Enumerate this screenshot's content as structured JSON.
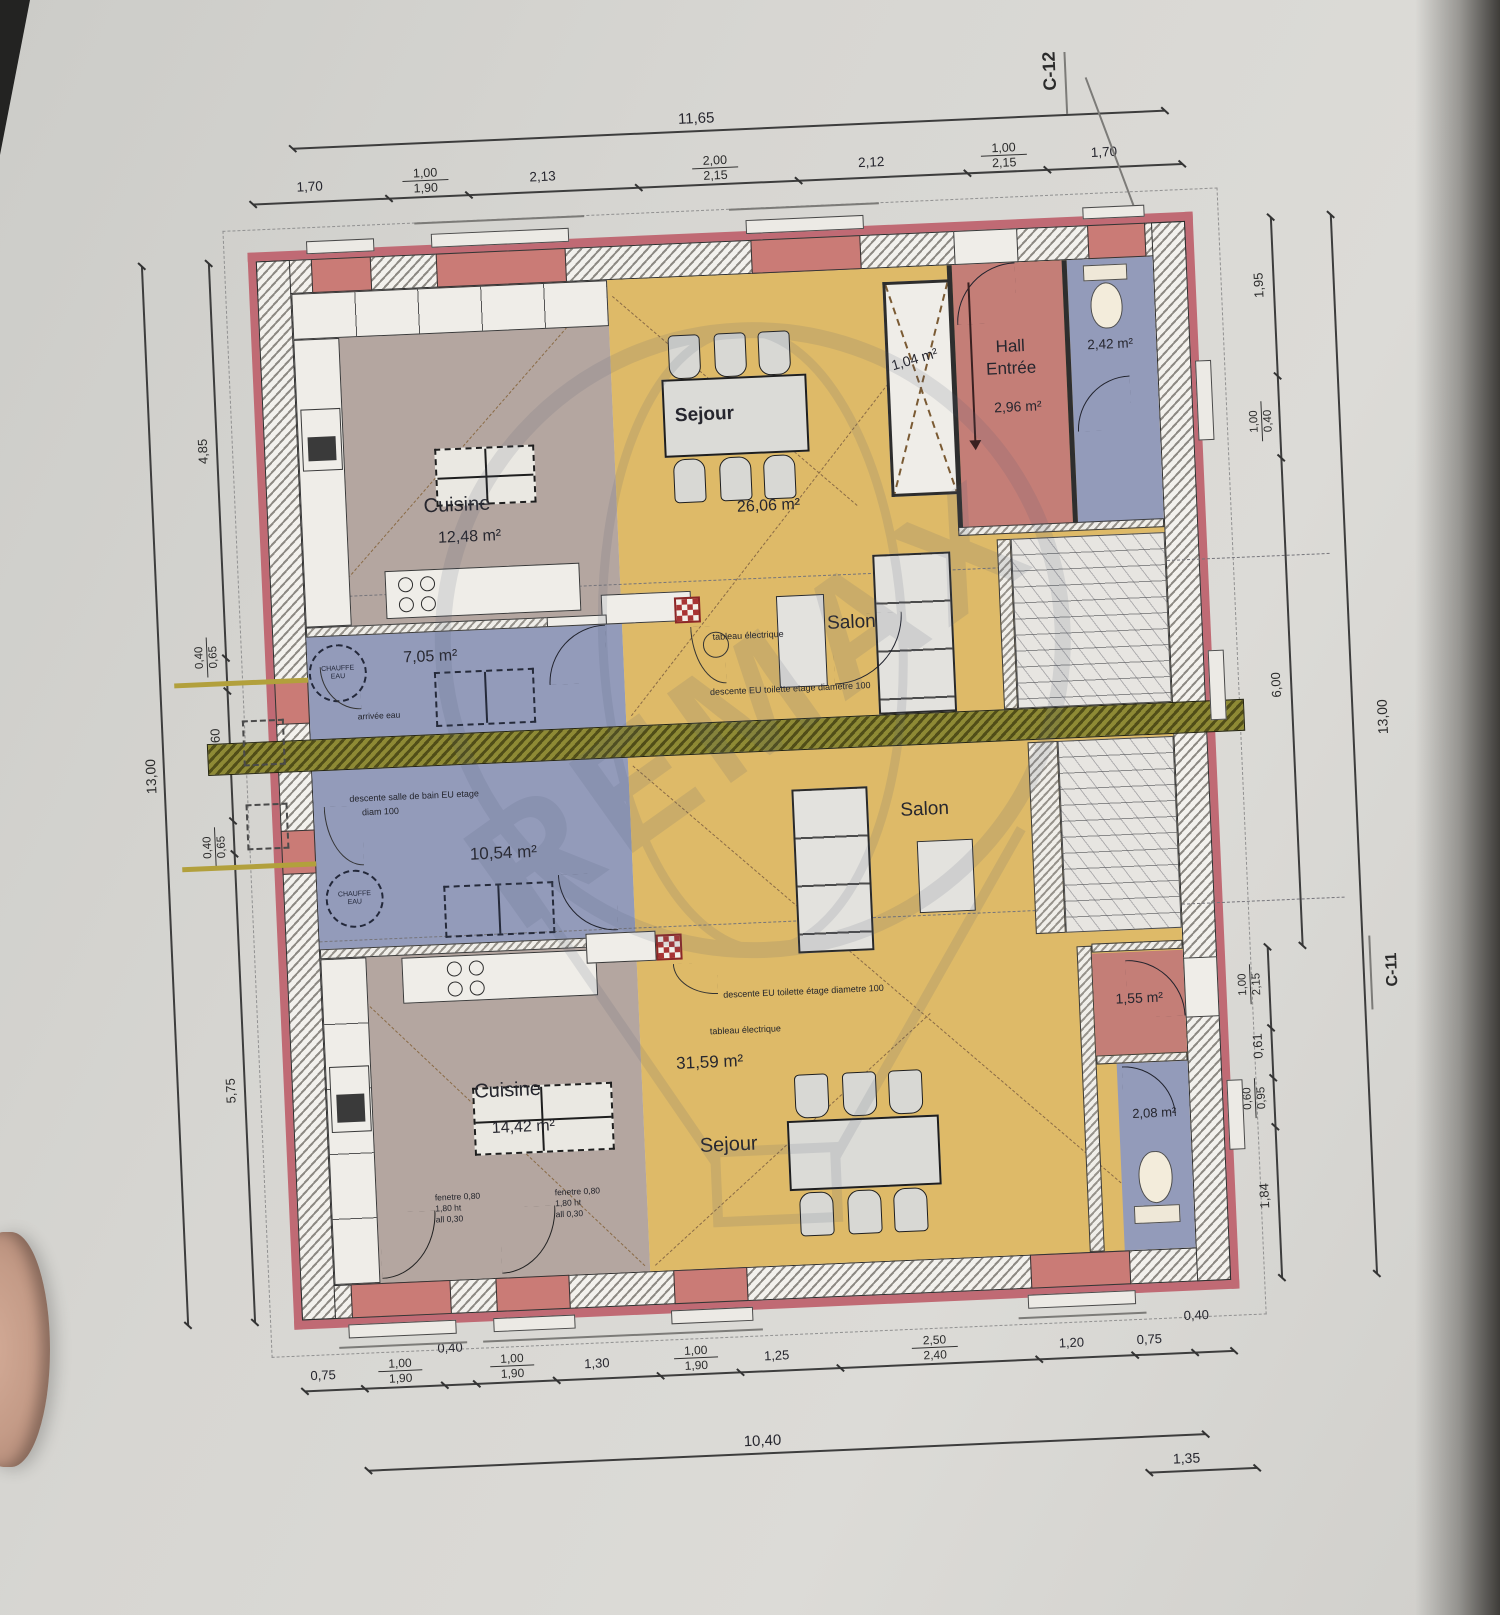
{
  "sections": {
    "c12": "C-12",
    "c11": "C-11"
  },
  "watermark": {
    "brand": "REMAX"
  },
  "rooms": {
    "u_cuisine_name": "Cuisine",
    "u_cuisine_area": "12,48 m²",
    "u_sejour_name": "Sejour",
    "u_sejour_area": "26,06 m²",
    "u_shaft_area": "1,04 m²",
    "u_hall_name1": "Hall",
    "u_hall_name2": "Entrée",
    "u_hall_area": "2,96 m²",
    "u_wc_area": "2,42 m²",
    "u_tech_area": "7,05 m²",
    "u_salon_name": "Salon",
    "l_tech_area": "10,54 m²",
    "l_cuisine_name": "Cuisine",
    "l_cuisine_area": "14,42 m²",
    "l_sejour_area": "31,59 m²",
    "l_sejour_name": "Sejour",
    "l_salon_name": "Salon",
    "l_hall_area": "1,55 m²",
    "l_wc_area": "2,08 m²",
    "chauffe1": "CHAUFFE",
    "chauffe2": "EAU"
  },
  "annotations": {
    "u_tableau": "tableau électrique",
    "u_arrivee": "arrivée eau",
    "u_descente": "descente EU toilette etage diametre 100",
    "l_descente_sdb1": "descente salle de bain EU etage",
    "l_descente_sdb2": "diam 100",
    "l_descente": "descente EU toilette étage diametre 100",
    "l_tableau": "tableau électrique",
    "fen1_l1": "fenetre 0,80",
    "fen1_l2": "1,80 ht",
    "fen1_l3": "all 0,30",
    "fen2_l1": "fenetre 0,80",
    "fen2_l2": "1,80 ht",
    "fen2_l3": "all 0,30"
  },
  "dims": {
    "top": {
      "overall": "11,65",
      "s1": "1,70",
      "s2a": "1,00",
      "s2b": "1,90",
      "s3": "2,13",
      "s4a": "2,00",
      "s4b": "2,15",
      "s5": "2,12",
      "s6a": "1,00",
      "s6b": "2,15",
      "s7": "1,70"
    },
    "bottom": {
      "overall": "10,40",
      "offset_right": "1,35",
      "s1": "0,75",
      "s2a": "1,00",
      "s2b": "1,90",
      "s3": "0,40",
      "s4a": "1,00",
      "s4b": "1,90",
      "s5": "1,30",
      "s6a": "1,00",
      "s6b": "1,90",
      "s7": "1,25",
      "s8a": "2,50",
      "s8b": "2,40",
      "s9": "1,20",
      "s10": "0,75",
      "s11": "0,40"
    },
    "left": {
      "overall": "13,00",
      "s1": "4,85",
      "s2a": "0,40",
      "s2b": "0,65",
      "s3": "1,60",
      "s4a": "0,40",
      "s4b": "0,65",
      "s5": "5,75"
    },
    "right": {
      "overall": "13,00",
      "s1": "1,95",
      "s2a": "1,00",
      "s2b": "0,40",
      "s3": "6,00",
      "s4a": "1,00",
      "s4b": "2,15",
      "s5": "0,61",
      "s6a": "0,60",
      "s6b": "0,95",
      "s7": "1,84"
    }
  }
}
